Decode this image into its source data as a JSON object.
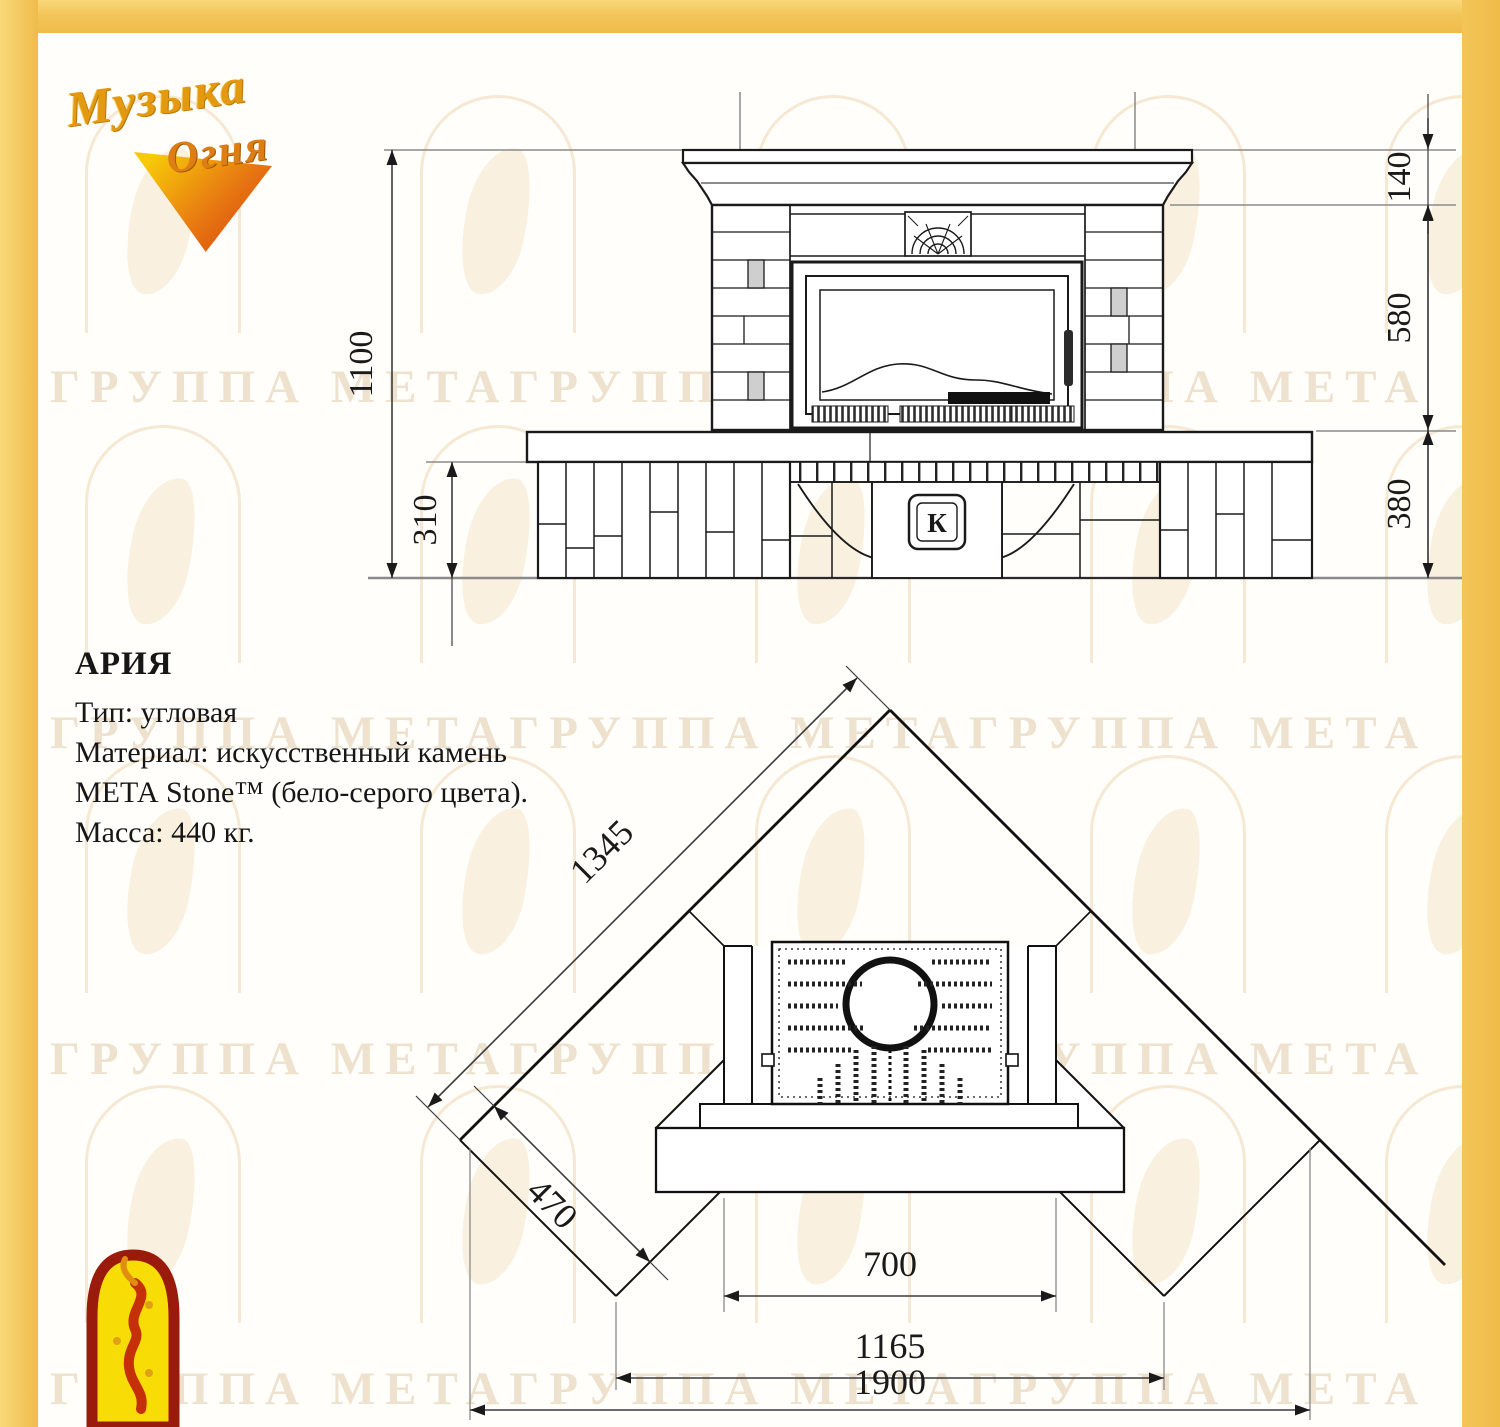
{
  "brand_logo": {
    "line1": "Музыка",
    "line2": "Огня"
  },
  "watermark": {
    "row_text": "ГРУППА МЕТАГРУППА МЕТАГРУППА МЕТА ГРУППА МЕТА"
  },
  "product_info": {
    "name": "АРИЯ",
    "lines": [
      "Тип: угловая",
      "Материал: искусственный камень",
      "МЕТА Stone™ (бело-серого цвета).",
      "Масса: 440 кг."
    ]
  },
  "front_view": {
    "dim_total_height": "1100",
    "dim_plinth_height": "310",
    "dim_mantel": "140",
    "dim_firebox_zone": "580",
    "dim_base": "380",
    "firebox_badge": "К"
  },
  "plan_view": {
    "dim_wall_length": "1345",
    "dim_side_depth": "470",
    "dim_opening_width": "700",
    "dim_hearth_width": "1165",
    "dim_overall_width": "1900"
  }
}
